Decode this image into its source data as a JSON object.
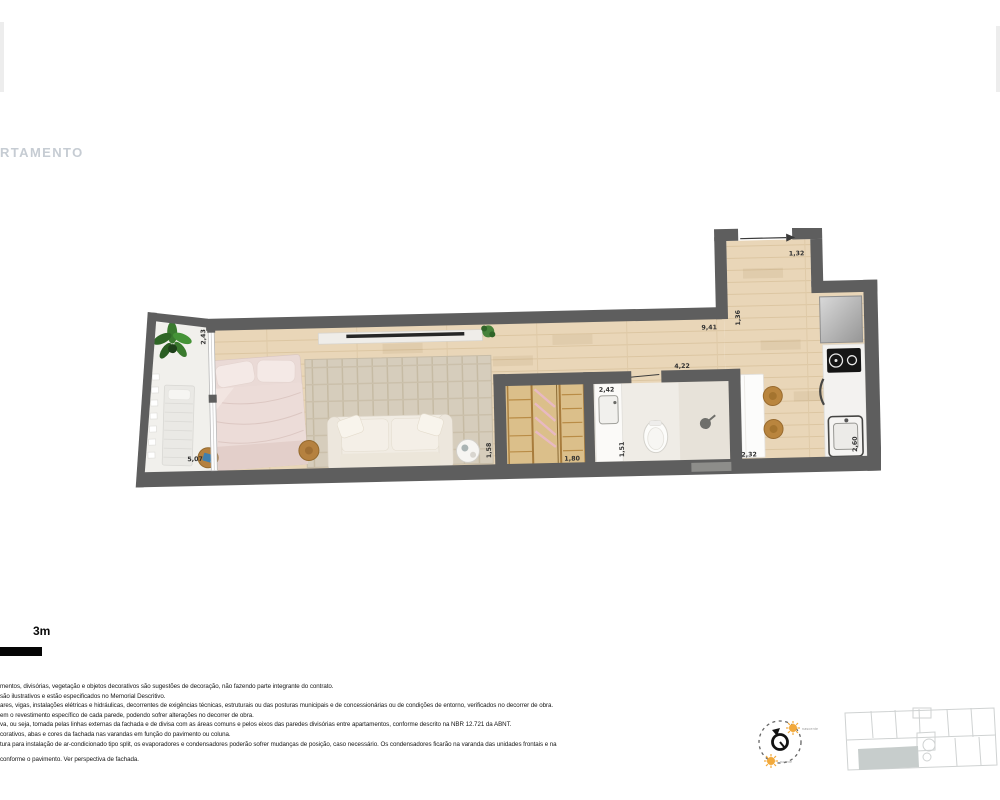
{
  "page": {
    "title": "RTAMENTO",
    "background": "#ffffff"
  },
  "plan": {
    "name": "apartment-floor-plan",
    "wall_color": "#5e5e5e",
    "floor_color": "#e9d6b8",
    "dimensions": {
      "balcony": "2,43",
      "bedroom": "5,07",
      "living": "1,58",
      "wardrobe": "1,80",
      "bathroom_vanity": "2,42",
      "bathroom_width": "1,51",
      "dining": "4,22",
      "dining_table": "2,32",
      "hall_length": "9,41",
      "hall_width": "1,36",
      "entry_door": "1,32",
      "kitchen": "2,60"
    }
  },
  "scale_bar": {
    "label": "3m"
  },
  "disclaimer": {
    "lines": [
      "mentos, divisórias, vegetação e objetos decorativos são sugestões de decoração, não fazendo parte integrante do contrato.",
      "são ilustrativos e estão especificados no Memorial Descritivo.",
      "ares, vigas, instalações elétricas e hidráulicas, decorrentes de exigências técnicas, estruturais ou das posturas municipais e de concessionárias ou de condições de entorno, verificados no decorrer de obra.",
      "em o revestimento específico de cada parede, podendo sofrer alterações no decorrer de obra.",
      "va, ou seja, tomada pelas linhas externas da fachada e de divisa com as áreas comuns e pelos eixos das paredes divisórias entre apartamentos, conforme descrito na NBR 12.721 da ABNT.",
      "corativos, abas e cores da fachada nas varandas em função do pavimento ou coluna.",
      "tura para instalação de ar-condicionado tipo split, os evaporadores e condensadores poderão sofrer mudanças de posição, caso necessário. Os condensadores ficarão na varanda das unidades frontais e na",
      "conforme o pavimento. Ver perspectiva de fachada."
    ]
  },
  "compass": {
    "sunrise": "nascente",
    "sunset": "poente"
  },
  "keyplan": {
    "highlight_color": "#c7cdcc"
  }
}
